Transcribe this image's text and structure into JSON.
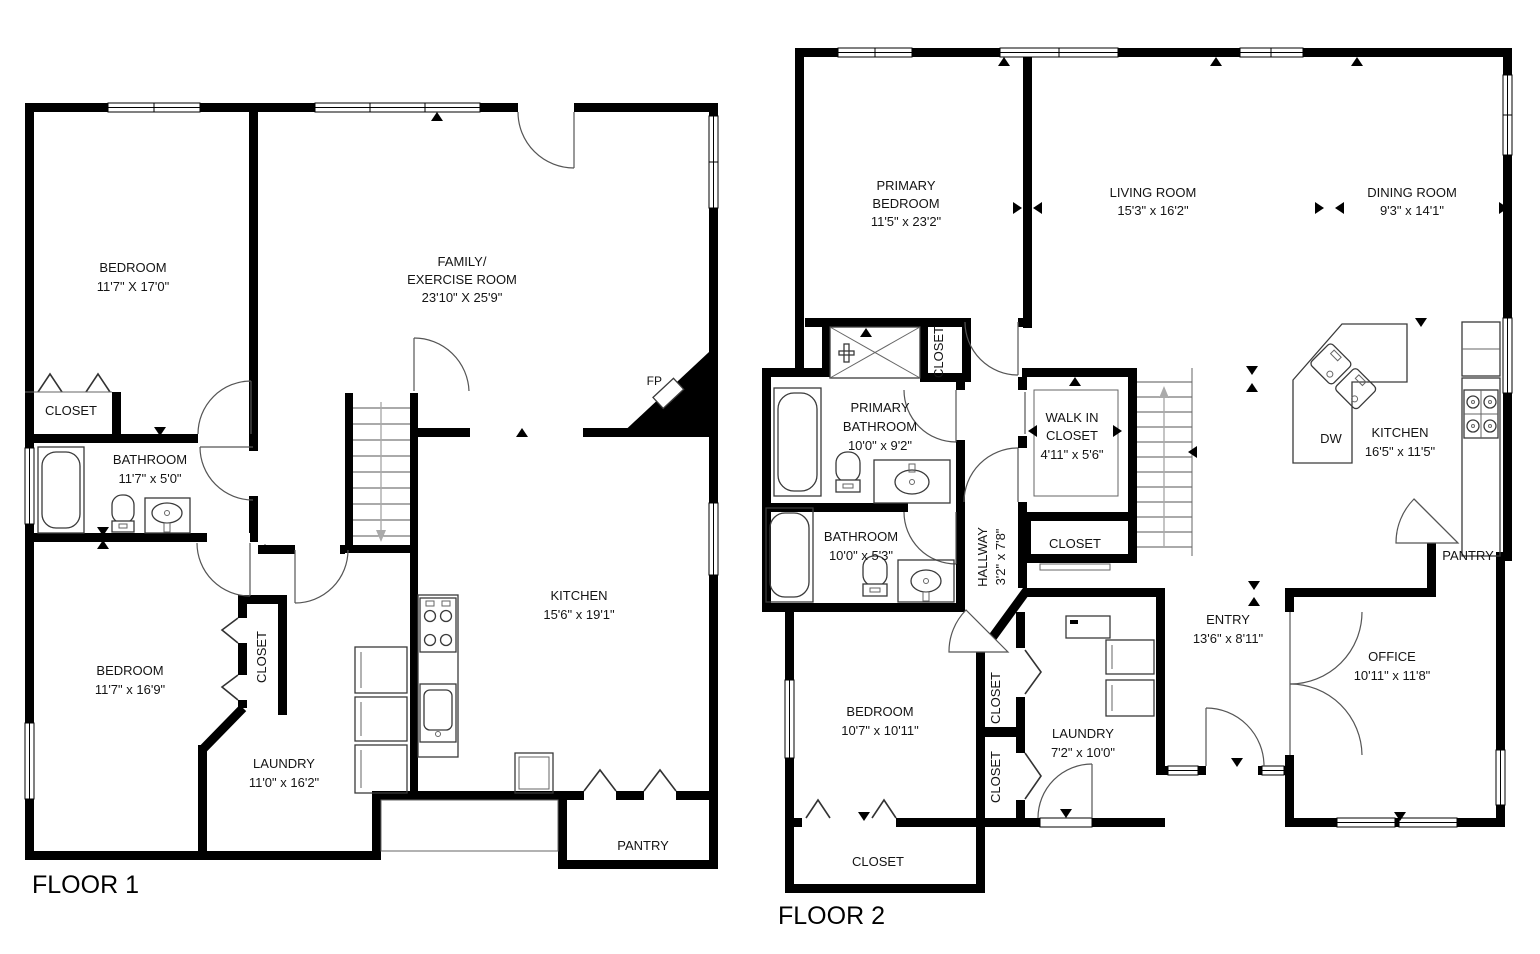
{
  "floor1": {
    "label": "FLOOR 1",
    "bedroom_tl": {
      "name": "BEDROOM",
      "dims": "11'7\" X 17'0\""
    },
    "closet_tl": {
      "name": "CLOSET"
    },
    "family": {
      "line1": "FAMILY/",
      "line2": "EXERCISE ROOM",
      "dims": "23'10\" X 25'9\""
    },
    "bathroom": {
      "name": "BATHROOM",
      "dims": "11'7\" x 5'0\""
    },
    "fireplace": {
      "abbr": "FP"
    },
    "bedroom_bl": {
      "name": "BEDROOM",
      "dims": "11'7\" x 16'9\""
    },
    "closet_bl": {
      "name": "CLOSET"
    },
    "laundry": {
      "name": "LAUNDRY",
      "dims": "11'0\" x 16'2\""
    },
    "kitchen": {
      "name": "KITCHEN",
      "dims": "15'6\" x 19'1\""
    },
    "pantry": {
      "name": "PANTRY"
    }
  },
  "floor2": {
    "label": "FLOOR 2",
    "primary_bedroom": {
      "line1": "PRIMARY",
      "line2": "BEDROOM",
      "dims": "11'5\" x 23'2\""
    },
    "living_room": {
      "name": "LIVING ROOM",
      "dims": "15'3\" x 16'2\""
    },
    "dining_room": {
      "name": "DINING ROOM",
      "dims": "9'3\" x 14'1\""
    },
    "primary_bathroom": {
      "line1": "PRIMARY",
      "line2": "BATHROOM",
      "dims": "10'0\" x 9'2\""
    },
    "primary_closet": {
      "name": "CLOSET"
    },
    "walk_in_closet": {
      "line1": "WALK IN",
      "line2": "CLOSET",
      "dims": "4'11\" x 5'6\""
    },
    "stair_closet": {
      "name": "CLOSET"
    },
    "bathroom": {
      "name": "BATHROOM",
      "dims": "10'0\" x 5'3\""
    },
    "hallway": {
      "name": "HALLWAY",
      "dims": "3'2\" x 7'8\""
    },
    "kitchen": {
      "name": "KITCHEN",
      "dims": "16'5\" x 11'5\""
    },
    "dishwasher": {
      "abbr": "DW"
    },
    "pantry": {
      "name": "PANTRY"
    },
    "bedroom": {
      "name": "BEDROOM",
      "dims": "10'7\" x 10'11\""
    },
    "closet_hall_1": {
      "name": "CLOSET"
    },
    "closet_hall_2": {
      "name": "CLOSET"
    },
    "laundry": {
      "name": "LAUNDRY",
      "dims": "7'2\" x 10'0\""
    },
    "closet_bottom": {
      "name": "CLOSET"
    },
    "entry": {
      "name": "ENTRY",
      "dims": "13'6\" x 8'11\""
    },
    "office": {
      "name": "OFFICE",
      "dims": "10'11\" x 11'8\""
    }
  }
}
